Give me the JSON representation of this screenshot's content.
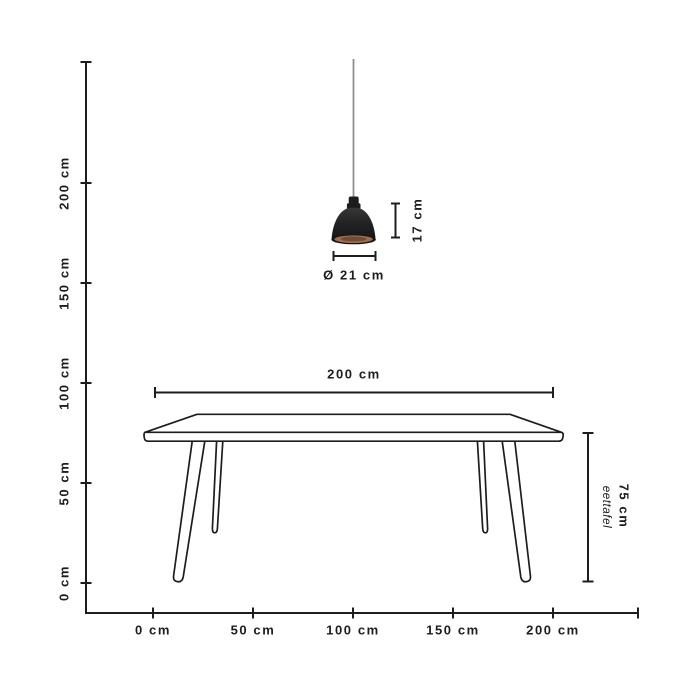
{
  "diagram": {
    "type": "product-dimension-diagram",
    "unit": "cm",
    "axes": {
      "y": {
        "unit": "cm",
        "range": [
          0,
          260
        ],
        "ticks": [
          "200 cm",
          "150 cm",
          "100 cm",
          "50 cm",
          "0 cm"
        ],
        "tick_values": [
          200,
          150,
          100,
          50,
          0
        ]
      },
      "x": {
        "unit": "cm",
        "range": [
          0,
          240
        ],
        "ticks": [
          "0 cm",
          "50 cm",
          "100 cm",
          "150 cm",
          "200 cm"
        ],
        "tick_values": [
          0,
          50,
          100,
          150,
          200
        ]
      }
    },
    "lamp": {
      "height_label": "17 cm",
      "diameter_label": "Ø 21 cm",
      "height_cm": 17,
      "diameter_cm": 21
    },
    "table": {
      "width_label": "200 cm",
      "height_label": "75 cm",
      "name_label": "eettafel",
      "width_cm": 200,
      "height_cm": 75
    },
    "colors": {
      "background": "#ffffff",
      "line": "#1d1d1d",
      "lamp_shade": "#1f1f1f",
      "lamp_reflector_copper": "#a06e4e",
      "lamp_reflector_center": "#744b36",
      "cord_gray": "#8f8f8f"
    }
  }
}
